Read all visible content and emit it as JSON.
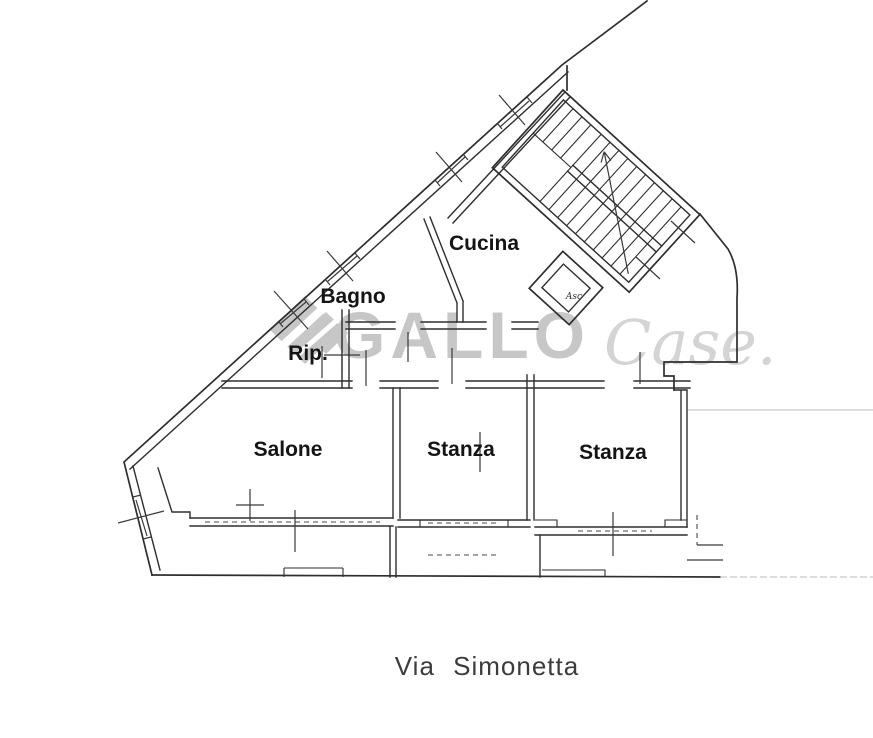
{
  "plan": {
    "caption": "Via Simonetta",
    "rooms": [
      {
        "id": "cucina",
        "label": "Cucina"
      },
      {
        "id": "bagno",
        "label": "Bagno"
      },
      {
        "id": "rip",
        "label": "Rip."
      },
      {
        "id": "salone",
        "label": "Salone"
      },
      {
        "id": "stanza-1",
        "label": "Stanza"
      },
      {
        "id": "stanza-2",
        "label": "Stanza"
      },
      {
        "id": "ascensore",
        "label": "Asc"
      }
    ]
  },
  "watermark": {
    "brand": "GALLO",
    "script": "Case.",
    "brand_color": "#c7c7c7",
    "script_color": "#d4d4d4"
  },
  "colors": {
    "background": "#ffffff",
    "wall": "#2e2e2e",
    "tick": "#3a3a3a",
    "label": "#141414",
    "caption": "#3c3c3c"
  }
}
